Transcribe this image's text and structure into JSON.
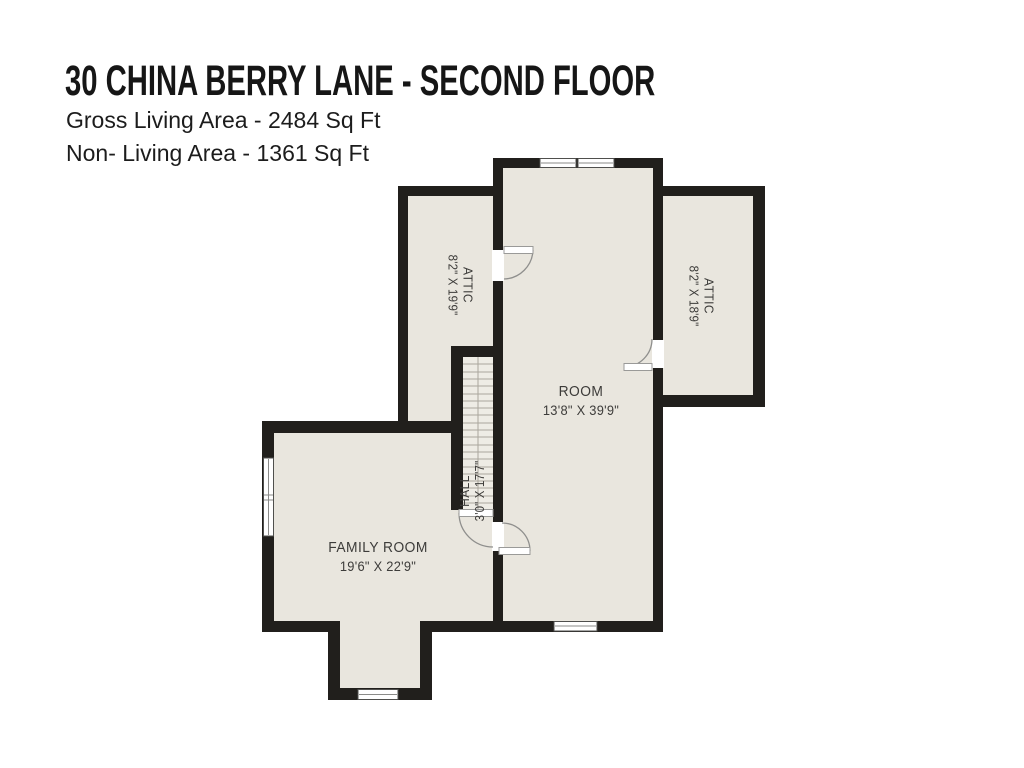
{
  "header": {
    "title": "30 CHINA BERRY LANE - SECOND FLOOR",
    "gross_living": "Gross Living Area - 2484 Sq Ft",
    "non_living": "Non- Living Area - 1361 Sq Ft"
  },
  "plan": {
    "rooms": {
      "room": {
        "name": "ROOM",
        "dims": "13'8\" X 39'9\""
      },
      "family_room": {
        "name": "FAMILY ROOM",
        "dims": "19'6\" X 22'9\""
      },
      "attic_left": {
        "name": "ATTIC",
        "dims": "8'2\" X 19'9\""
      },
      "attic_right": {
        "name": "ATTIC",
        "dims": "8'2\" X 18'9\""
      },
      "hall": {
        "name": "HALL",
        "dims": "3'0\" X 17'7\""
      }
    },
    "colors": {
      "floor_fill": "#e9e6de",
      "wall": "#211f1c",
      "label_text": "#3d3c3a",
      "background": "#ffffff"
    }
  }
}
